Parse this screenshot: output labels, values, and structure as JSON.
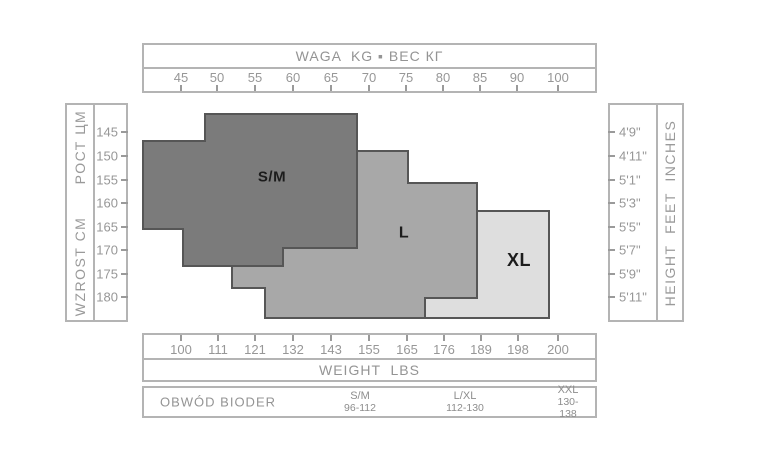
{
  "canvas": {
    "width": 768,
    "height": 456,
    "bg": "#ffffff"
  },
  "colors": {
    "box_border": "#b4b4b4",
    "axis_text": "#979797",
    "tick": "#9a9a9a",
    "region_stroke": "#565656",
    "region_label": "#1c1c1c"
  },
  "top_axis": {
    "title": "WAGA  KG ▪ ВЕС КГ",
    "unit": "kg",
    "ticks": [
      {
        "label": "45",
        "x": 181
      },
      {
        "label": "50",
        "x": 217
      },
      {
        "label": "55",
        "x": 255
      },
      {
        "label": "60",
        "x": 293
      },
      {
        "label": "65",
        "x": 331
      },
      {
        "label": "70",
        "x": 369
      },
      {
        "label": "75",
        "x": 406
      },
      {
        "label": "80",
        "x": 443
      },
      {
        "label": "85",
        "x": 480
      },
      {
        "label": "90",
        "x": 517
      },
      {
        "label": "100",
        "x": 558
      }
    ]
  },
  "bottom_axis": {
    "title": "WEIGHT  LBS",
    "unit": "lbs",
    "ticks": [
      {
        "label": "100",
        "x": 181
      },
      {
        "label": "111",
        "x": 218
      },
      {
        "label": "121",
        "x": 255
      },
      {
        "label": "132",
        "x": 293
      },
      {
        "label": "143",
        "x": 331
      },
      {
        "label": "155",
        "x": 369
      },
      {
        "label": "165",
        "x": 407
      },
      {
        "label": "176",
        "x": 444
      },
      {
        "label": "189",
        "x": 481
      },
      {
        "label": "198",
        "x": 518
      },
      {
        "label": "200",
        "x": 558
      }
    ]
  },
  "left_axis": {
    "title": "WZROST CM      РОСТ ЦМ",
    "unit": "cm",
    "ticks": [
      {
        "label": "145",
        "y": 132
      },
      {
        "label": "150",
        "y": 156
      },
      {
        "label": "155",
        "y": 180
      },
      {
        "label": "160",
        "y": 203
      },
      {
        "label": "165",
        "y": 227
      },
      {
        "label": "170",
        "y": 250
      },
      {
        "label": "175",
        "y": 274
      },
      {
        "label": "180",
        "y": 297
      }
    ]
  },
  "right_axis": {
    "title": "HEIGHT  FEET  INCHES",
    "unit": "feet-inches",
    "ticks": [
      {
        "label": "4'9\"",
        "y": 132
      },
      {
        "label": "4'11\"",
        "y": 156
      },
      {
        "label": "5'1\"",
        "y": 180
      },
      {
        "label": "5'3\"",
        "y": 203
      },
      {
        "label": "5'5\"",
        "y": 227
      },
      {
        "label": "5'7\"",
        "y": 250
      },
      {
        "label": "5'9\"",
        "y": 274
      },
      {
        "label": "5'11\"",
        "y": 297
      }
    ]
  },
  "hips": {
    "label": "OBWÓD BIODER",
    "columns": [
      {
        "size": "S/M",
        "range": "96-112",
        "x": 360
      },
      {
        "size": "L/XL",
        "range": "112-130",
        "x": 465
      },
      {
        "size": "XXL",
        "range": "130-138",
        "x": 568
      }
    ]
  },
  "chart_data": {
    "type": "area",
    "title": "Hosiery size chart: weight vs height stepped size regions",
    "x_axis_top": {
      "label": "WAGA  KG ▪ ВЕС КГ",
      "ticks": [
        45,
        50,
        55,
        60,
        65,
        70,
        75,
        80,
        85,
        90,
        100
      ]
    },
    "x_axis_bottom": {
      "label": "WEIGHT  LBS",
      "ticks": [
        100,
        111,
        121,
        132,
        143,
        155,
        165,
        176,
        189,
        198,
        200
      ]
    },
    "y_axis_left": {
      "label": "WZROST CM  РОСТ ЦМ",
      "ticks": [
        145,
        150,
        155,
        160,
        165,
        170,
        175,
        180
      ]
    },
    "y_axis_right": {
      "label": "HEIGHT FEET INCHES",
      "ticks": [
        "4'9\"",
        "4'11\"",
        "5'1\"",
        "5'3\"",
        "5'5\"",
        "5'7\"",
        "5'9\"",
        "5'11\""
      ]
    },
    "grid": false,
    "regions": [
      {
        "label": "S/M",
        "fill": "#7b7b7b",
        "approx_kg_range": [
          40,
          68.5
        ],
        "approx_cm_range": [
          141,
          173.5
        ],
        "label_pos": [
          272,
          177
        ],
        "label_size": 15,
        "vertices_px": [
          [
            205,
            114
          ],
          [
            357,
            114
          ],
          [
            357,
            248
          ],
          [
            283,
            248
          ],
          [
            283,
            266
          ],
          [
            183,
            266
          ],
          [
            183,
            229
          ],
          [
            143,
            229
          ],
          [
            143,
            141
          ],
          [
            205,
            141
          ]
        ]
      },
      {
        "label": "L",
        "fill": "#a8a8a8",
        "approx_kg_range": [
          52,
          84.5
        ],
        "approx_cm_range": [
          149,
          184
        ],
        "label_pos": [
          404,
          233
        ],
        "label_size": 16,
        "vertices_px": [
          [
            357,
            151
          ],
          [
            408,
            151
          ],
          [
            408,
            183
          ],
          [
            477,
            183
          ],
          [
            477,
            298
          ],
          [
            425,
            298
          ],
          [
            425,
            318
          ],
          [
            265,
            318
          ],
          [
            265,
            288
          ],
          [
            232,
            288
          ],
          [
            232,
            265
          ],
          [
            283,
            265
          ],
          [
            283,
            248
          ],
          [
            357,
            248
          ]
        ]
      },
      {
        "label": "XL",
        "fill": "#dedede",
        "approx_kg_range": [
          77.5,
          94
        ],
        "approx_cm_range": [
          162,
          184
        ],
        "label_pos": [
          519,
          260
        ],
        "label_size": 18,
        "vertices_px": [
          [
            477,
            211
          ],
          [
            549,
            211
          ],
          [
            549,
            318
          ],
          [
            425,
            318
          ],
          [
            425,
            298
          ],
          [
            477,
            298
          ]
        ]
      }
    ],
    "hip_circumference_cm": {
      "label": "OBWÓD BIODER",
      "sizes": [
        {
          "size": "S/M",
          "range": "96-112"
        },
        {
          "size": "L/XL",
          "range": "112-130"
        },
        {
          "size": "XXL",
          "range": "130-138"
        }
      ]
    }
  }
}
